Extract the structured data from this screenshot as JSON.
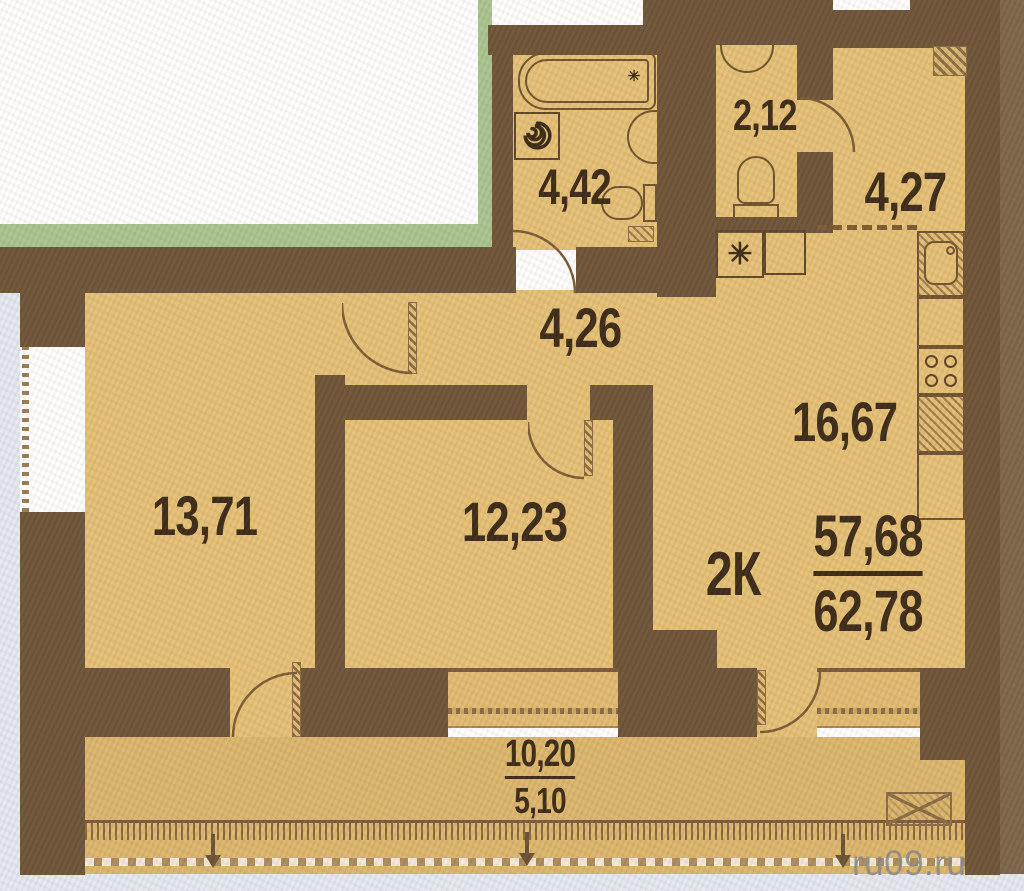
{
  "unit": {
    "type_label": "2К",
    "area_living": "57,68",
    "area_total": "62,78"
  },
  "rooms": {
    "bathroom": {
      "area": "4,42"
    },
    "wc": {
      "area": "2,12"
    },
    "hallway": {
      "area": "4,27"
    },
    "corridor": {
      "area": "4,26"
    },
    "kitchen": {
      "area": "16,67"
    },
    "room_left": {
      "area": "13,71"
    },
    "room_center": {
      "area": "12,23"
    }
  },
  "balcony": {
    "area_full": "10,20",
    "area_reduced": "5,10"
  },
  "watermark": {
    "text": "ru09.ru"
  },
  "symbols": {
    "vent_star": "✳"
  },
  "colors": {
    "wall": "#6d5437",
    "floor": "#e5c076",
    "floor_balcony": "#dcb66c",
    "exterior_accent_green": "#a9c48f",
    "label_text": "#3b2a18",
    "fixture_outline": "#6f522f",
    "scan_edge": "#e4e9f1",
    "right_edge": "#7d6548",
    "watermark_gray": "#8a8a8a"
  }
}
